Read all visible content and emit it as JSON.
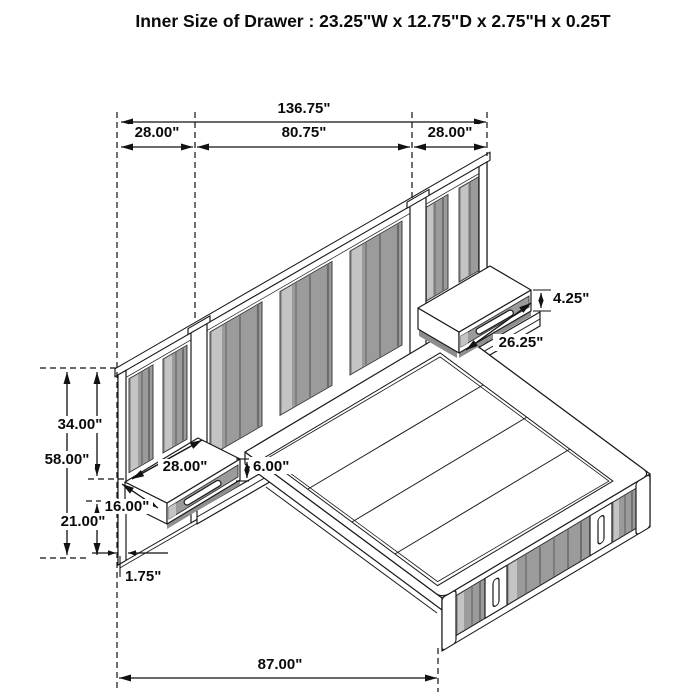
{
  "title": "Inner Size of Drawer : 23.25\"W x 12.75\"D x 2.75\"H x 0.25T",
  "dims": {
    "overall_width": "136.75\"",
    "left_panel_width": "28.00\"",
    "center_panel_width": "80.75\"",
    "right_panel_width": "28.00\"",
    "right_nightstand_height": "4.25\"",
    "right_nightstand_width": "26.25\"",
    "headboard_upper_height": "34.00\"",
    "headboard_total_height": "58.00\"",
    "headboard_lower_height": "21.00\"",
    "left_nightstand_width": "28.00\"",
    "left_nightstand_height": "6.00\"",
    "left_nightstand_depth": "16.00\"",
    "panel_thickness": "1.75\"",
    "platform_length": "87.00\""
  }
}
